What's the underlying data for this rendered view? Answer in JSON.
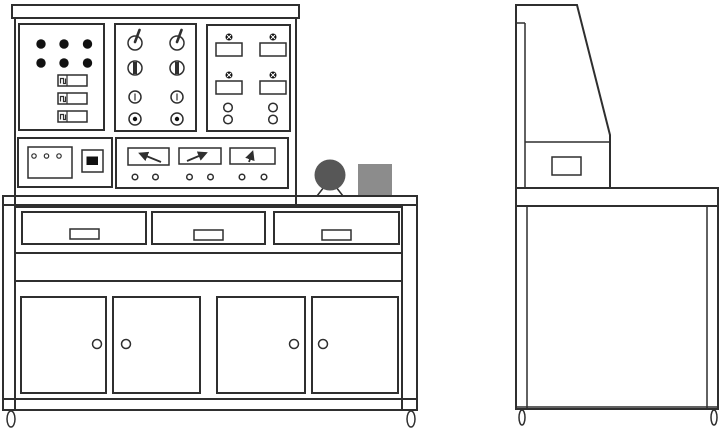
{
  "drawing": {
    "subject": "electrical training workbench technical drawing",
    "views": [
      "front",
      "side"
    ]
  },
  "colors": {
    "line": "#2f2f2f",
    "background": "#ffffff",
    "ink": "#111111",
    "motor_fill": "#575757",
    "box_fill": "#8c8c8c"
  },
  "front_view": {
    "console": {
      "top_strip": 1,
      "indicator_switch_panel": {
        "indicator_lights": 6,
        "rocker_switches": 3
      },
      "knob_panel": {
        "knobs_total": 8,
        "rows": [
          {
            "type": "lever-rotary-switch",
            "count": 2
          },
          {
            "type": "thick-bar-knob",
            "count": 2
          },
          {
            "type": "slotted-knob",
            "count": 2
          },
          {
            "type": "push-button",
            "count": 2
          }
        ]
      },
      "breaker_panel": {
        "breaker_modules": 4,
        "indicator_lamps": 4,
        "terminal_posts": 4
      },
      "socket_panel": {
        "three_pin_sockets": 1,
        "slot_sockets": 1
      },
      "meter_panel": {
        "analog_meters": 3,
        "needle_directions": [
          "up-left",
          "up-right",
          "up"
        ],
        "terminal_posts": 6
      }
    },
    "worktop_items": {
      "motors": 1,
      "accessory_boxes": 1
    },
    "bench": {
      "drawers": 3,
      "drawer_handles": 3,
      "cabinet_doors": 4,
      "door_knobs": 4,
      "casters": 2
    }
  },
  "side_view": {
    "back_panels": 1,
    "sloped_consoles": 1,
    "side_drawer_boxes": 1,
    "worktops": 1,
    "cabinets": 1,
    "casters": 2
  }
}
